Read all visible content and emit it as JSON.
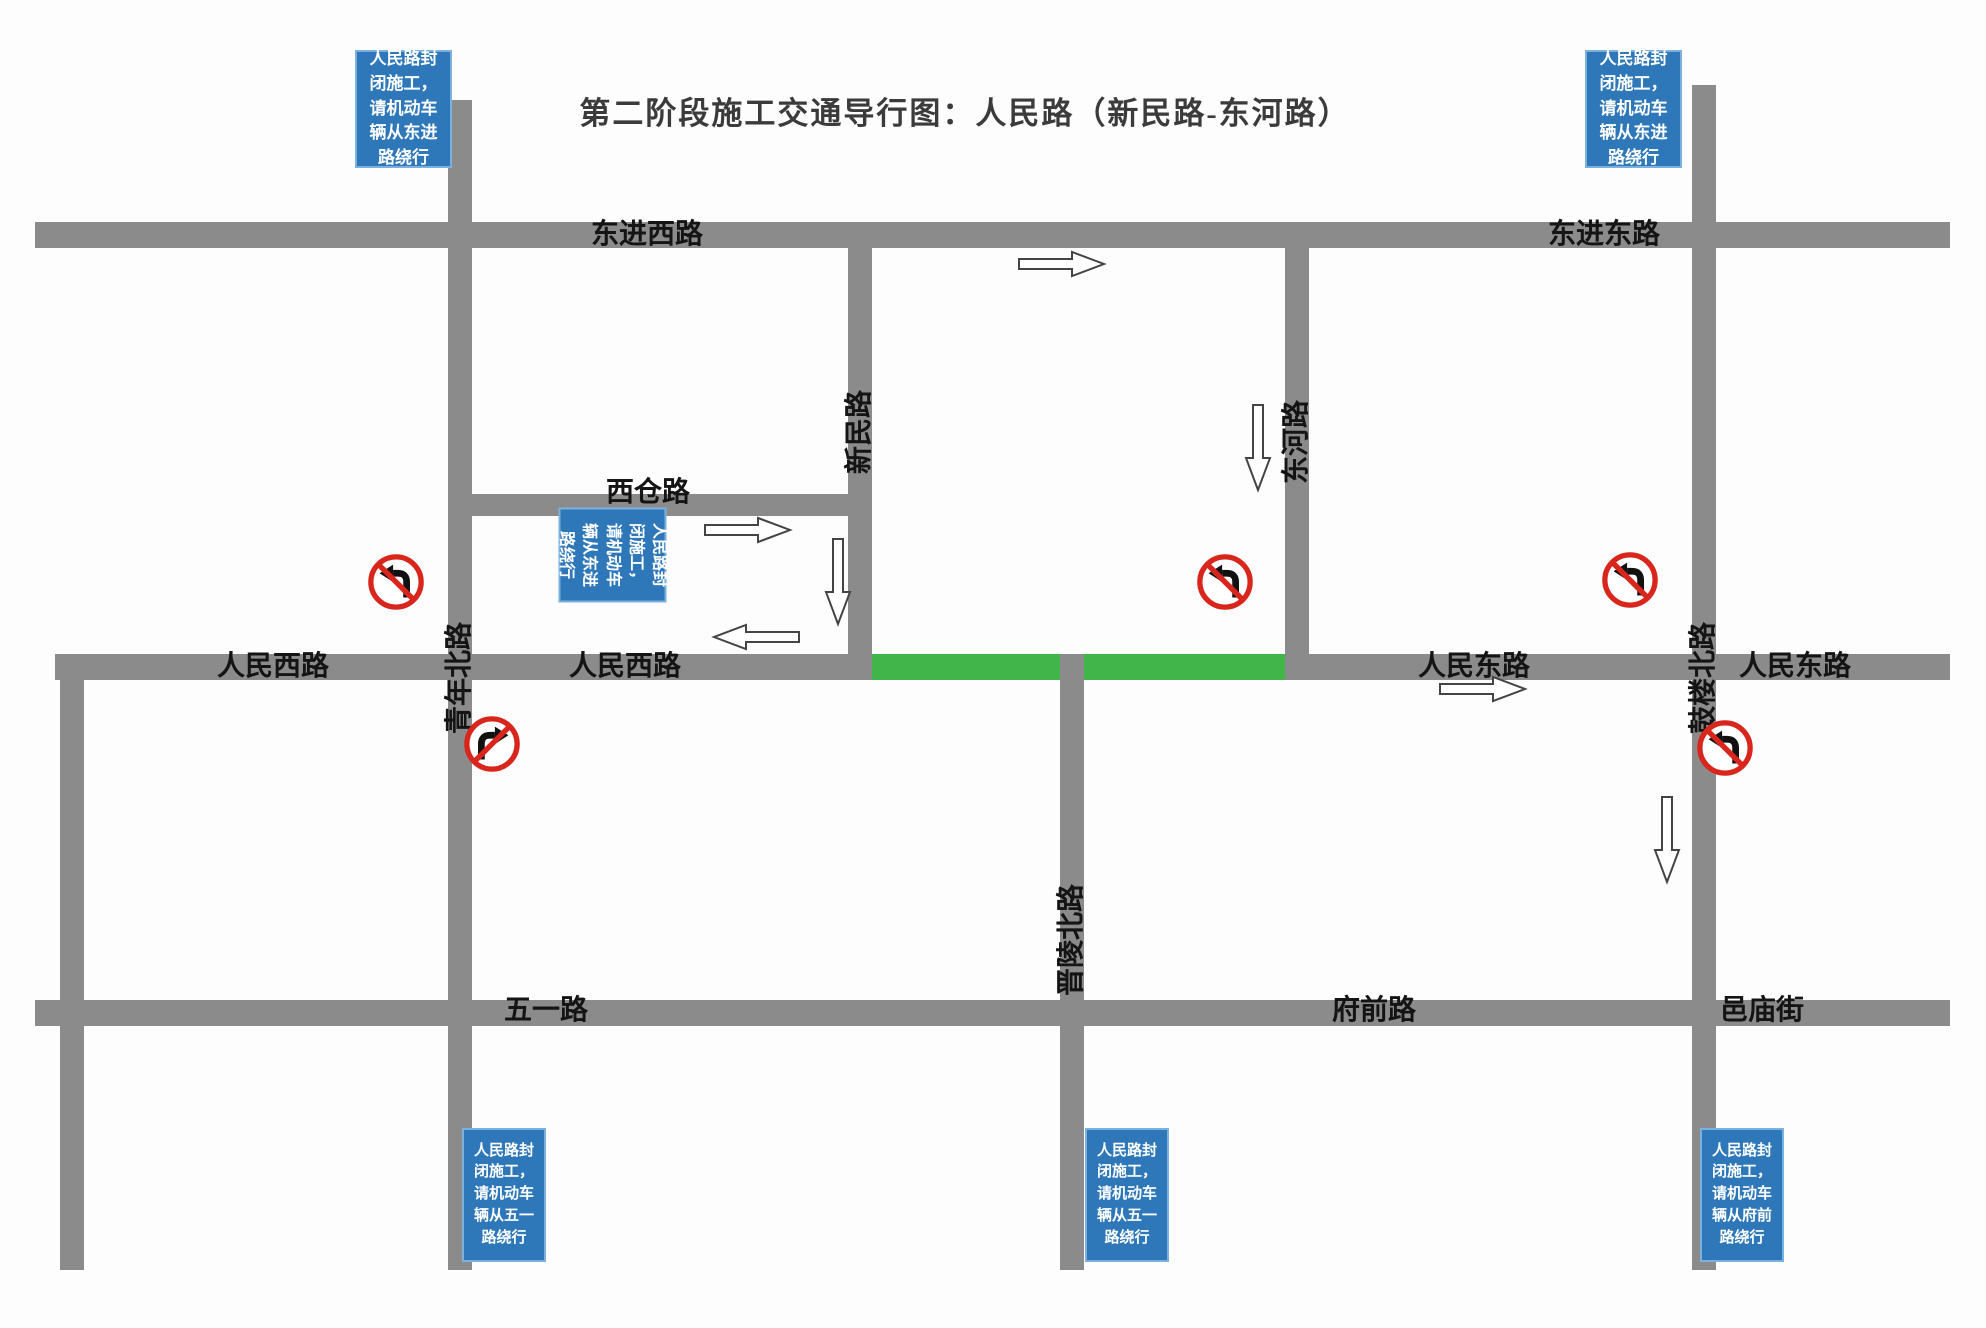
{
  "title": "第二阶段施工交通导行图：人民路（新民路-东河路）",
  "colors": {
    "road_gray": "#8b8b8b",
    "closure_green": "#3fb54a",
    "notice_blue": "#2e78b9",
    "prohibition_red": "#d9261c"
  },
  "roads": {
    "dongjin_west": "东进西路",
    "dongjin_east": "东进东路",
    "xicang": "西仓路",
    "xinmin": "新民路",
    "donghe": "东河路",
    "renmin_west_1": "人民西路",
    "renmin_west_2": "人民西路",
    "renmin_east_1": "人民东路",
    "renmin_east_2": "人民东路",
    "qingnian_north": "青年北路",
    "gulou_north": "鼓楼北路",
    "jinling_north": "晋陵北路",
    "wuyi": "五一路",
    "fuqian": "府前路",
    "yimiao": "邑庙街"
  },
  "notices": {
    "detour_dongjin": "人民路封闭施工，请机动车辆从东进路绕行",
    "detour_wuyi": "人民路封闭施工，请机动车辆从五一路绕行",
    "detour_fuqian": "人民路封闭施工，请机动车辆从府前路绕行"
  }
}
